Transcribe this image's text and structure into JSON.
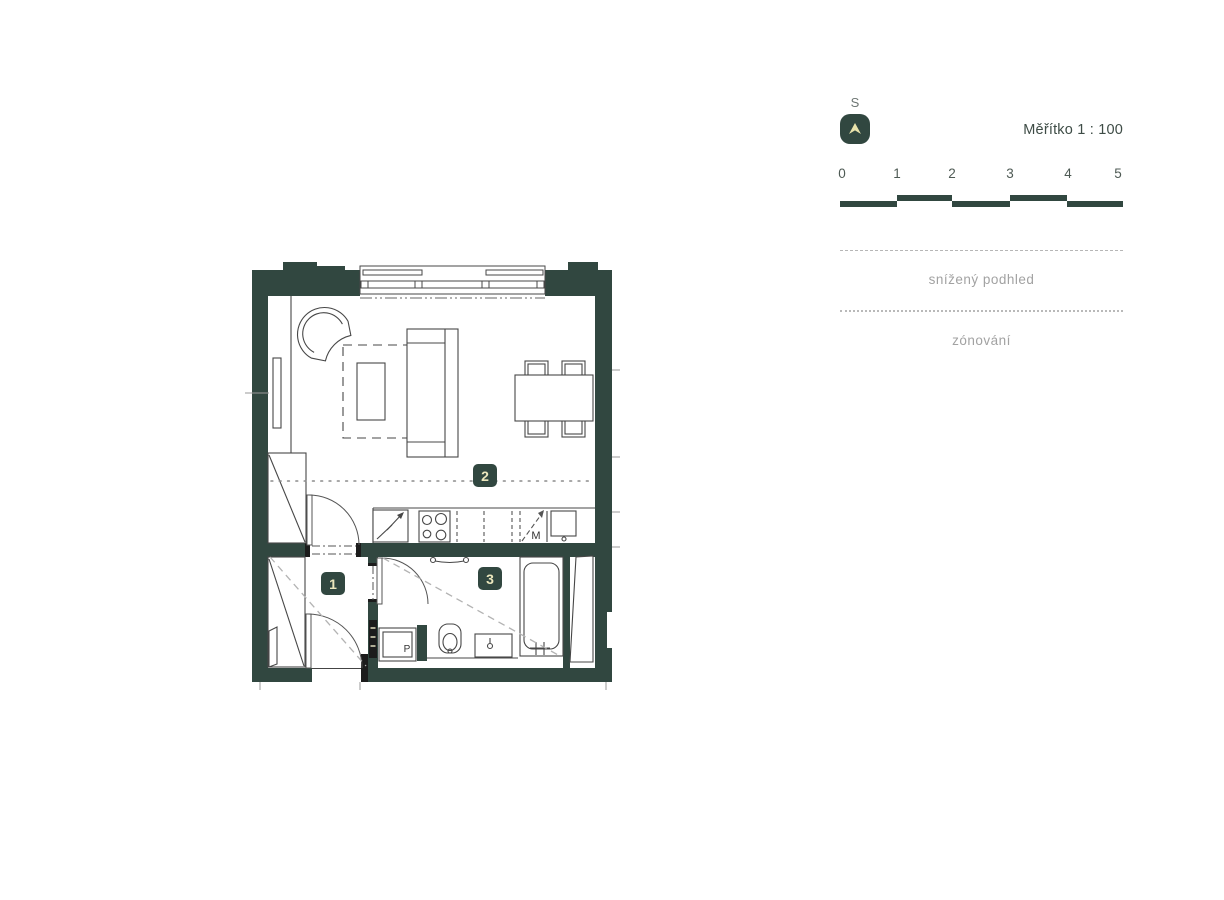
{
  "north": {
    "label": "S"
  },
  "scale": {
    "title": "Měřítko 1 : 100",
    "tick_labels": [
      "0",
      "1",
      "2",
      "3",
      "4",
      "5"
    ]
  },
  "legend": [
    {
      "label": "snížený podhled",
      "line_style": "dashed"
    },
    {
      "label": "zónování",
      "line_style": "dotted"
    }
  ],
  "plan": {
    "room_labels": [
      {
        "number": "1"
      },
      {
        "number": "2"
      },
      {
        "number": "3"
      }
    ],
    "appliance_labels": {
      "dishwasher": "M",
      "washing_machine": "P"
    }
  },
  "colors": {
    "wall_green": "#314740",
    "label_text": "#ece7bd",
    "legend_gray": "#a2a2a2",
    "accent_arrow": "#e9e3ab"
  }
}
